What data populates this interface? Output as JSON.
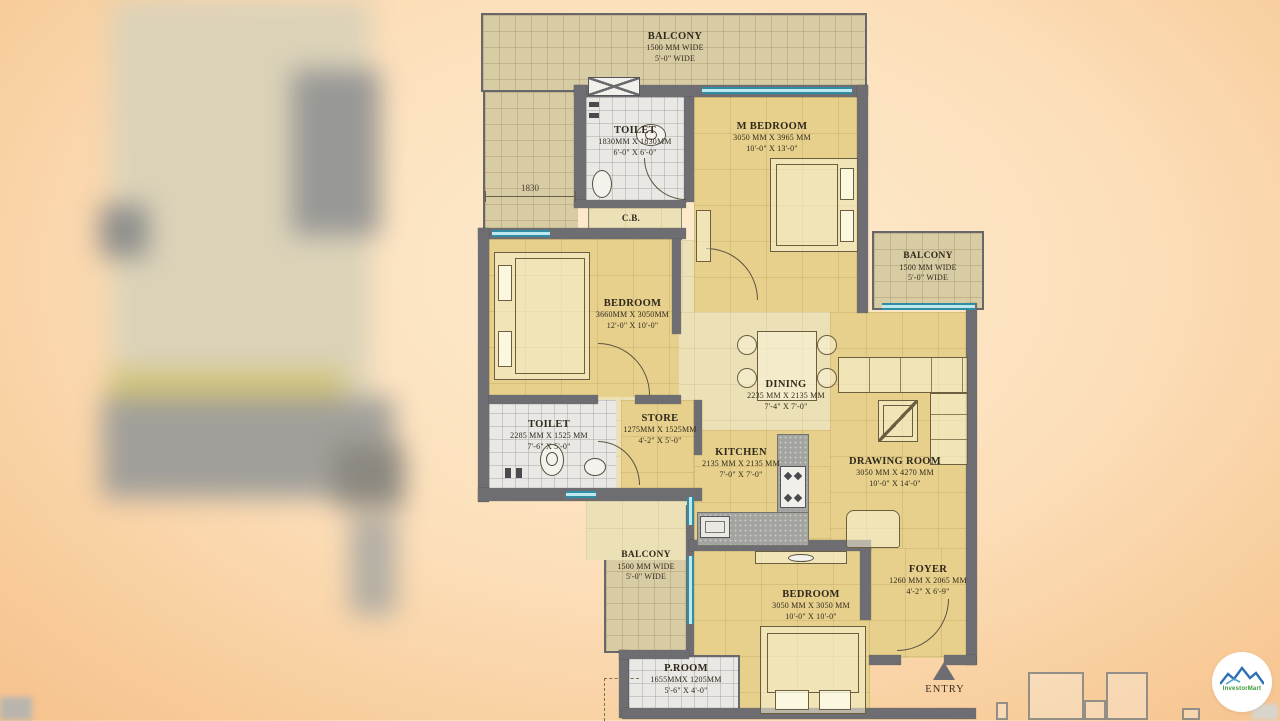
{
  "colors": {
    "background_center": "#fdeccf",
    "background_edge": "#f5c08a",
    "floor_yellow": "#e6d08c",
    "floor_pale": "#ece0b6",
    "balcony_tan": "#d8cca4",
    "tile_white": "#e9e8e4",
    "wall_gray": "#6d6d72",
    "window_teal": "#2f8ea3",
    "label_ink": "#30291c",
    "logo_mountain_blue": "#2e6fb5",
    "logo_text_green": "#3a9a35"
  },
  "plan": {
    "rooms": {
      "balcony_top": {
        "name": "BALCONY",
        "dim_mm": "1500 MM WIDE",
        "dim_ft": "5'-0\" WIDE"
      },
      "toilet_top": {
        "name": "TOILET",
        "dim_mm": "1830MM X 1830MM",
        "dim_ft": "6'-0\" X 6'-0\""
      },
      "m_bedroom": {
        "name": "M BEDROOM",
        "dim_mm": "3050 MM X 3965 MM",
        "dim_ft": "10'-0\" X 13'-0\""
      },
      "cb": {
        "name": "C.B."
      },
      "bedroom_left": {
        "name": "BEDROOM",
        "dim_mm": "3660MM X 3050MM",
        "dim_ft": "12'-0\" X 10'-0\""
      },
      "balcony_right": {
        "name": "BALCONY",
        "dim_mm": "1500 MM WIDE",
        "dim_ft": "5'-0\" WIDE"
      },
      "dining": {
        "name": "DINING",
        "dim_mm": "2235 MM X 2135 MM",
        "dim_ft": "7'-4\" X 7'-0\""
      },
      "drawing_room": {
        "name": "DRAWING ROOM",
        "dim_mm": "3050 MM X 4270 MM",
        "dim_ft": "10'-0\" X 14'-0\""
      },
      "toilet_left": {
        "name": "TOILET",
        "dim_mm": "2285 MM X 1525 MM",
        "dim_ft": "7'-6\" X 5'-0\""
      },
      "store": {
        "name": "STORE",
        "dim_mm": "1275MM X 1525MM",
        "dim_ft": "4'-2\" X 5'-0\""
      },
      "kitchen": {
        "name": "KITCHEN",
        "dim_mm": "2135 MM X 2135 MM",
        "dim_ft": "7'-0\" X 7'-0\""
      },
      "balcony_bottom": {
        "name": "BALCONY",
        "dim_mm": "1500 MM WIDE",
        "dim_ft": "5'-0\" WIDE"
      },
      "bedroom_bottom": {
        "name": "BEDROOM",
        "dim_mm": "3050 MM X 3050 MM",
        "dim_ft": "10'-0\" X 10'-0\""
      },
      "foyer": {
        "name": "FOYER",
        "dim_mm": "1260 MM X 2065 MM",
        "dim_ft": "4'-2\" X 6'-9\""
      },
      "p_room": {
        "name": "P.ROOM",
        "dim_mm": "1655MMX 1205MM",
        "dim_ft": "5'-6\" X 4'-0\""
      }
    },
    "annotations": {
      "dim_left": "1830",
      "entry_label": "ENTRY"
    }
  },
  "watermark": {
    "text": "InvestorMart"
  }
}
